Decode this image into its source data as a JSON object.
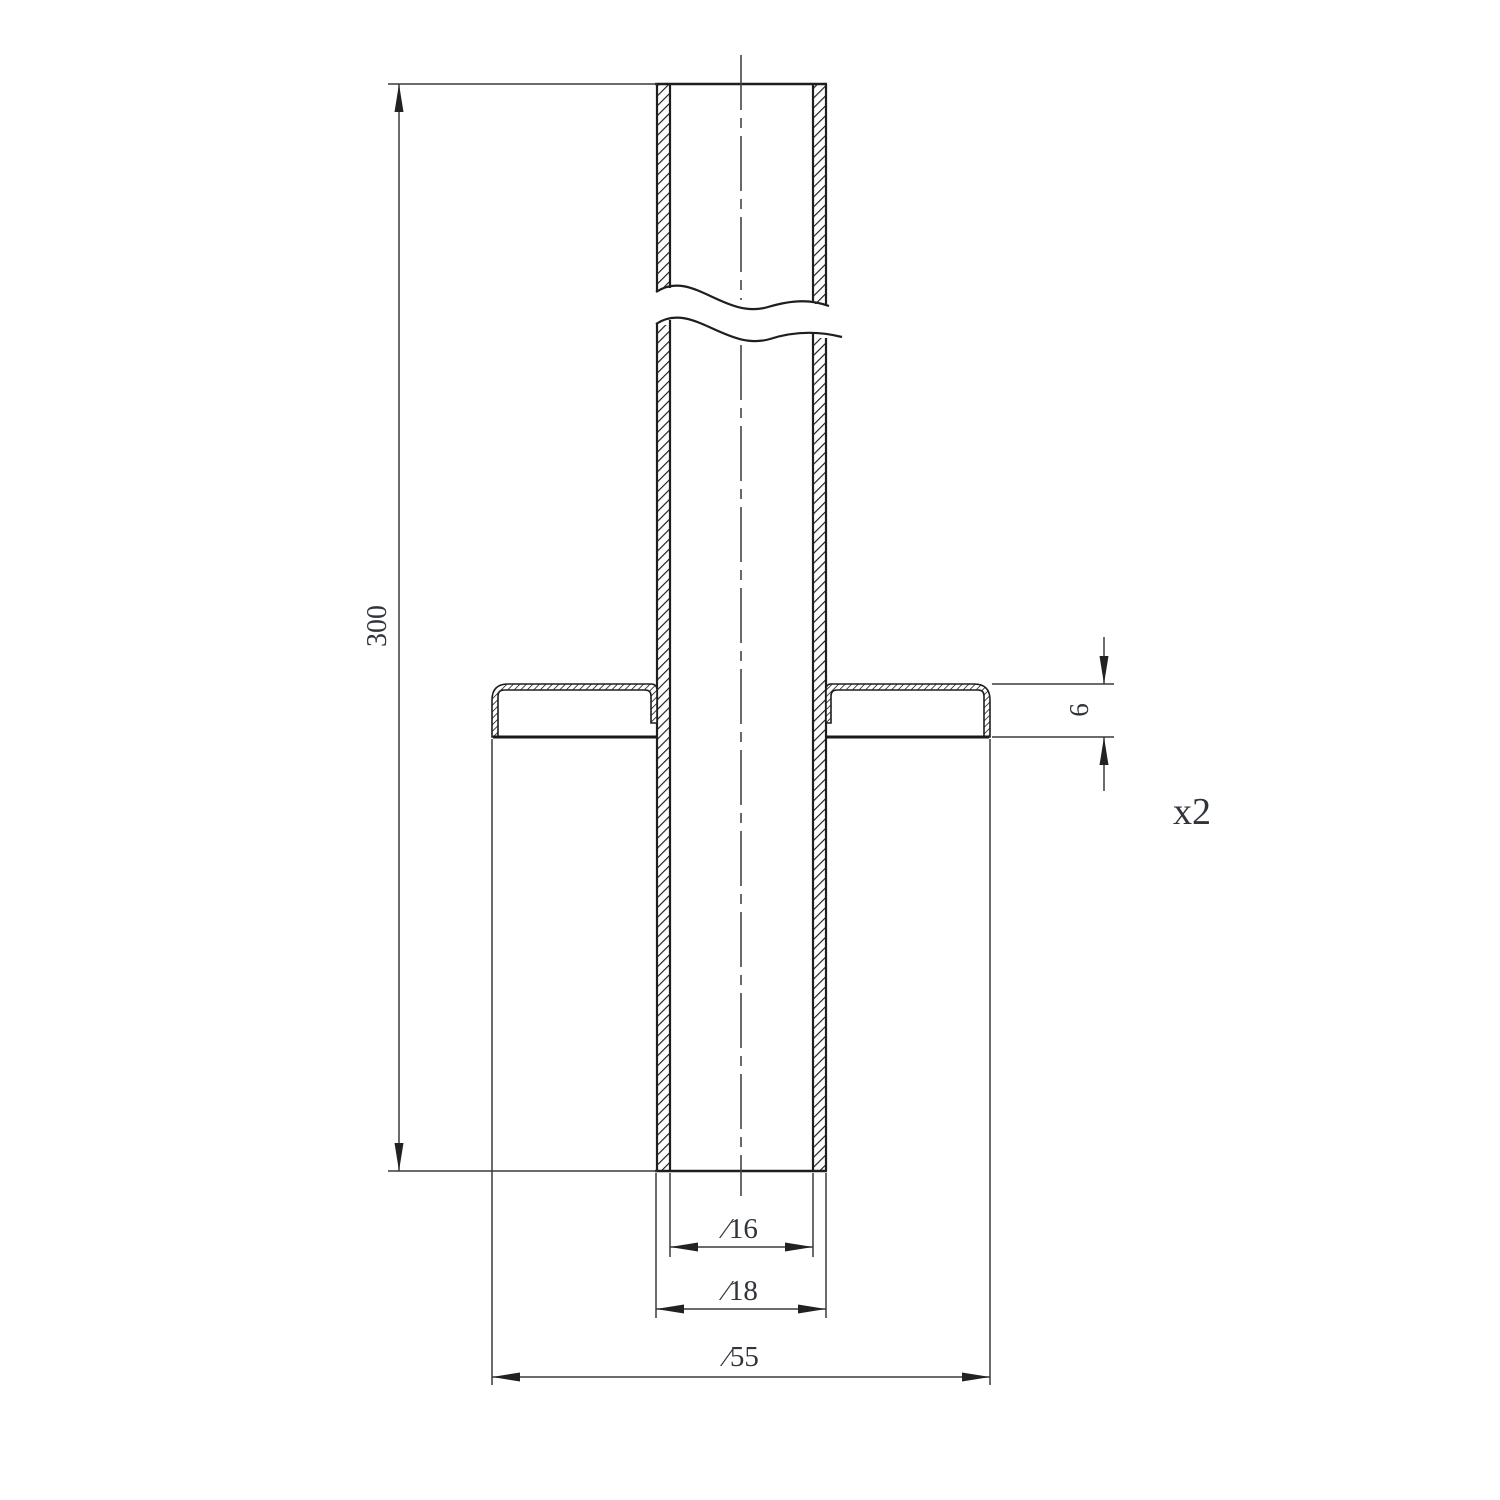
{
  "drawing": {
    "labels": {
      "length": "300",
      "flange_height": "6",
      "quantity": "x2",
      "inner_diameter": "∕16",
      "outer_diameter": "∕18",
      "flange_diameter": "∕55"
    },
    "colors": {
      "background": "#ffffff",
      "object_line": "#1e1e1e",
      "dimension_line": "#3a3a3a",
      "text": "#30343c"
    }
  }
}
